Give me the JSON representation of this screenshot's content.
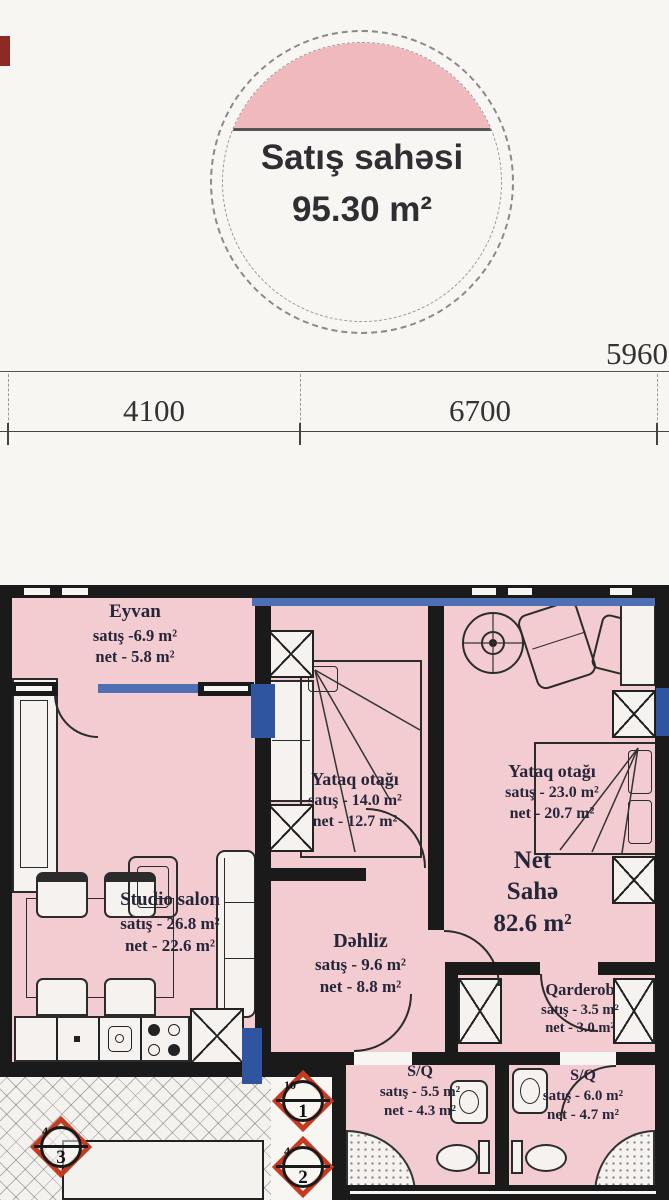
{
  "badge": {
    "title": "Satış sahəsi",
    "value": "95.30 m²"
  },
  "dimensions": {
    "top_right": "5960",
    "left_span": "4100",
    "right_span": "6700"
  },
  "summary": {
    "line1": "Net",
    "line2": "Sahə",
    "value": "82.6 m²"
  },
  "rooms": [
    {
      "name": "Eyvan",
      "satis": "satış -6.9 m²",
      "net": "net - 5.8 m²"
    },
    {
      "name": "Studio salon",
      "satis": "satış - 26.8 m²",
      "net": "net - 22.6 m²"
    },
    {
      "name": "Yataq otağı",
      "satis": "satış - 14.0 m²",
      "net": "net - 12.7 m²"
    },
    {
      "name": "Yataq otağı",
      "satis": "satış - 23.0 m²",
      "net": "net - 20.7 m²"
    },
    {
      "name": "Dəhliz",
      "satis": "satış - 9.6 m²",
      "net": "net - 8.8 m²"
    },
    {
      "name": "Qarderob",
      "satis": "satış - 3.5 m²",
      "net": "net - 3.0 m²"
    },
    {
      "name": "S/Q",
      "satis": "satış - 5.5 m²",
      "net": "net - 4.3 m²"
    },
    {
      "name": "S/Q",
      "satis": "satış - 6.0 m²",
      "net": "net - 4.7 m²"
    }
  ],
  "markers": [
    {
      "label": "1",
      "sub": "10"
    },
    {
      "label": "2",
      "sub": "4"
    },
    {
      "label": "3",
      "sub": "4"
    }
  ],
  "colors": {
    "floor_pink": "#f3ccd1",
    "wall_black": "#1a1a1a",
    "window_blue": "#4e6fb3",
    "accent_blue": "#2f55a0",
    "marker_red": "#c63a20",
    "paper": "#f7f6f3"
  }
}
